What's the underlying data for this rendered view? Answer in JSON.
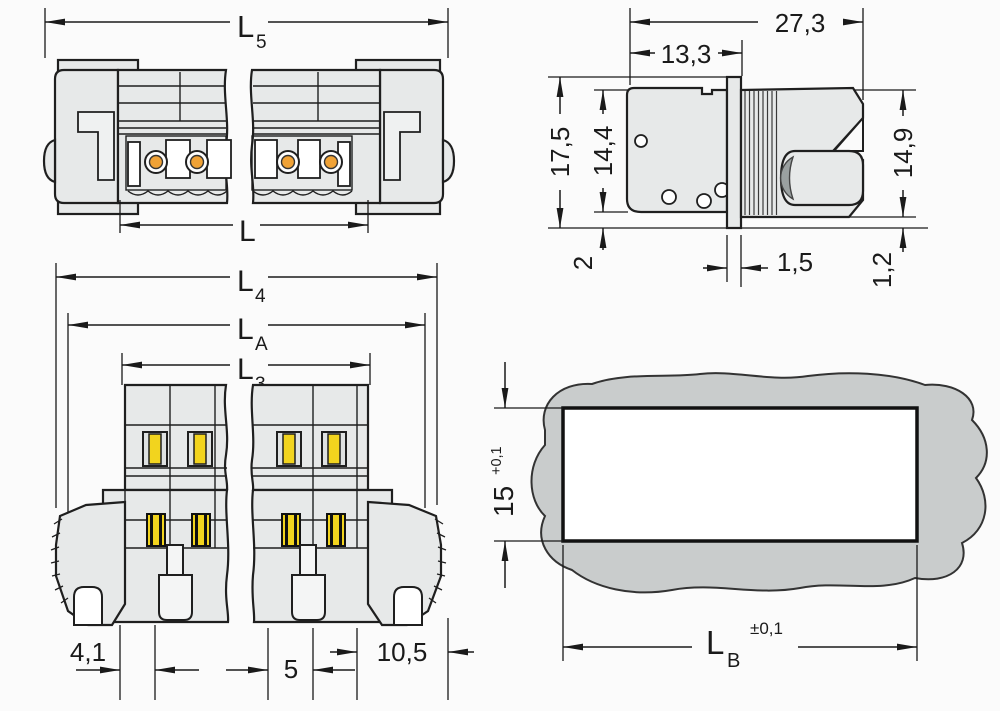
{
  "drawing": {
    "top_view": {
      "l5_main": "L",
      "l5_sub": "5",
      "l_label": "L"
    },
    "side_view": {
      "width_overall": "27,3",
      "width_front": "13,3",
      "height_flange": "17,5",
      "height_body": "14,4",
      "height_rear": "14,9",
      "gap_bottom_left": "2",
      "flange_thickness": "1,5",
      "gap_bottom_right": "1,2"
    },
    "front_view": {
      "l4_main": "L",
      "l4_sub": "4",
      "la_main": "L",
      "la_sub": "A",
      "l3_main": "L",
      "l3_sub": "3",
      "edge_to_pole": "4,1",
      "pole_pitch": "5",
      "end_width": "10,5"
    },
    "cutout_view": {
      "cutout_height": "15",
      "cutout_height_tolerance": "+0,1",
      "lb_main": "L",
      "lb_sub": "B",
      "lb_tolerance": "±0,1"
    }
  },
  "colors": {
    "line": "#1a1a1a",
    "body_fill": "#e7e9e9",
    "panel_fill": "#c9cccc",
    "lever_yellow": "#f2d41e",
    "contact_orange": "#f0a236",
    "background": "#fbfbfb"
  }
}
